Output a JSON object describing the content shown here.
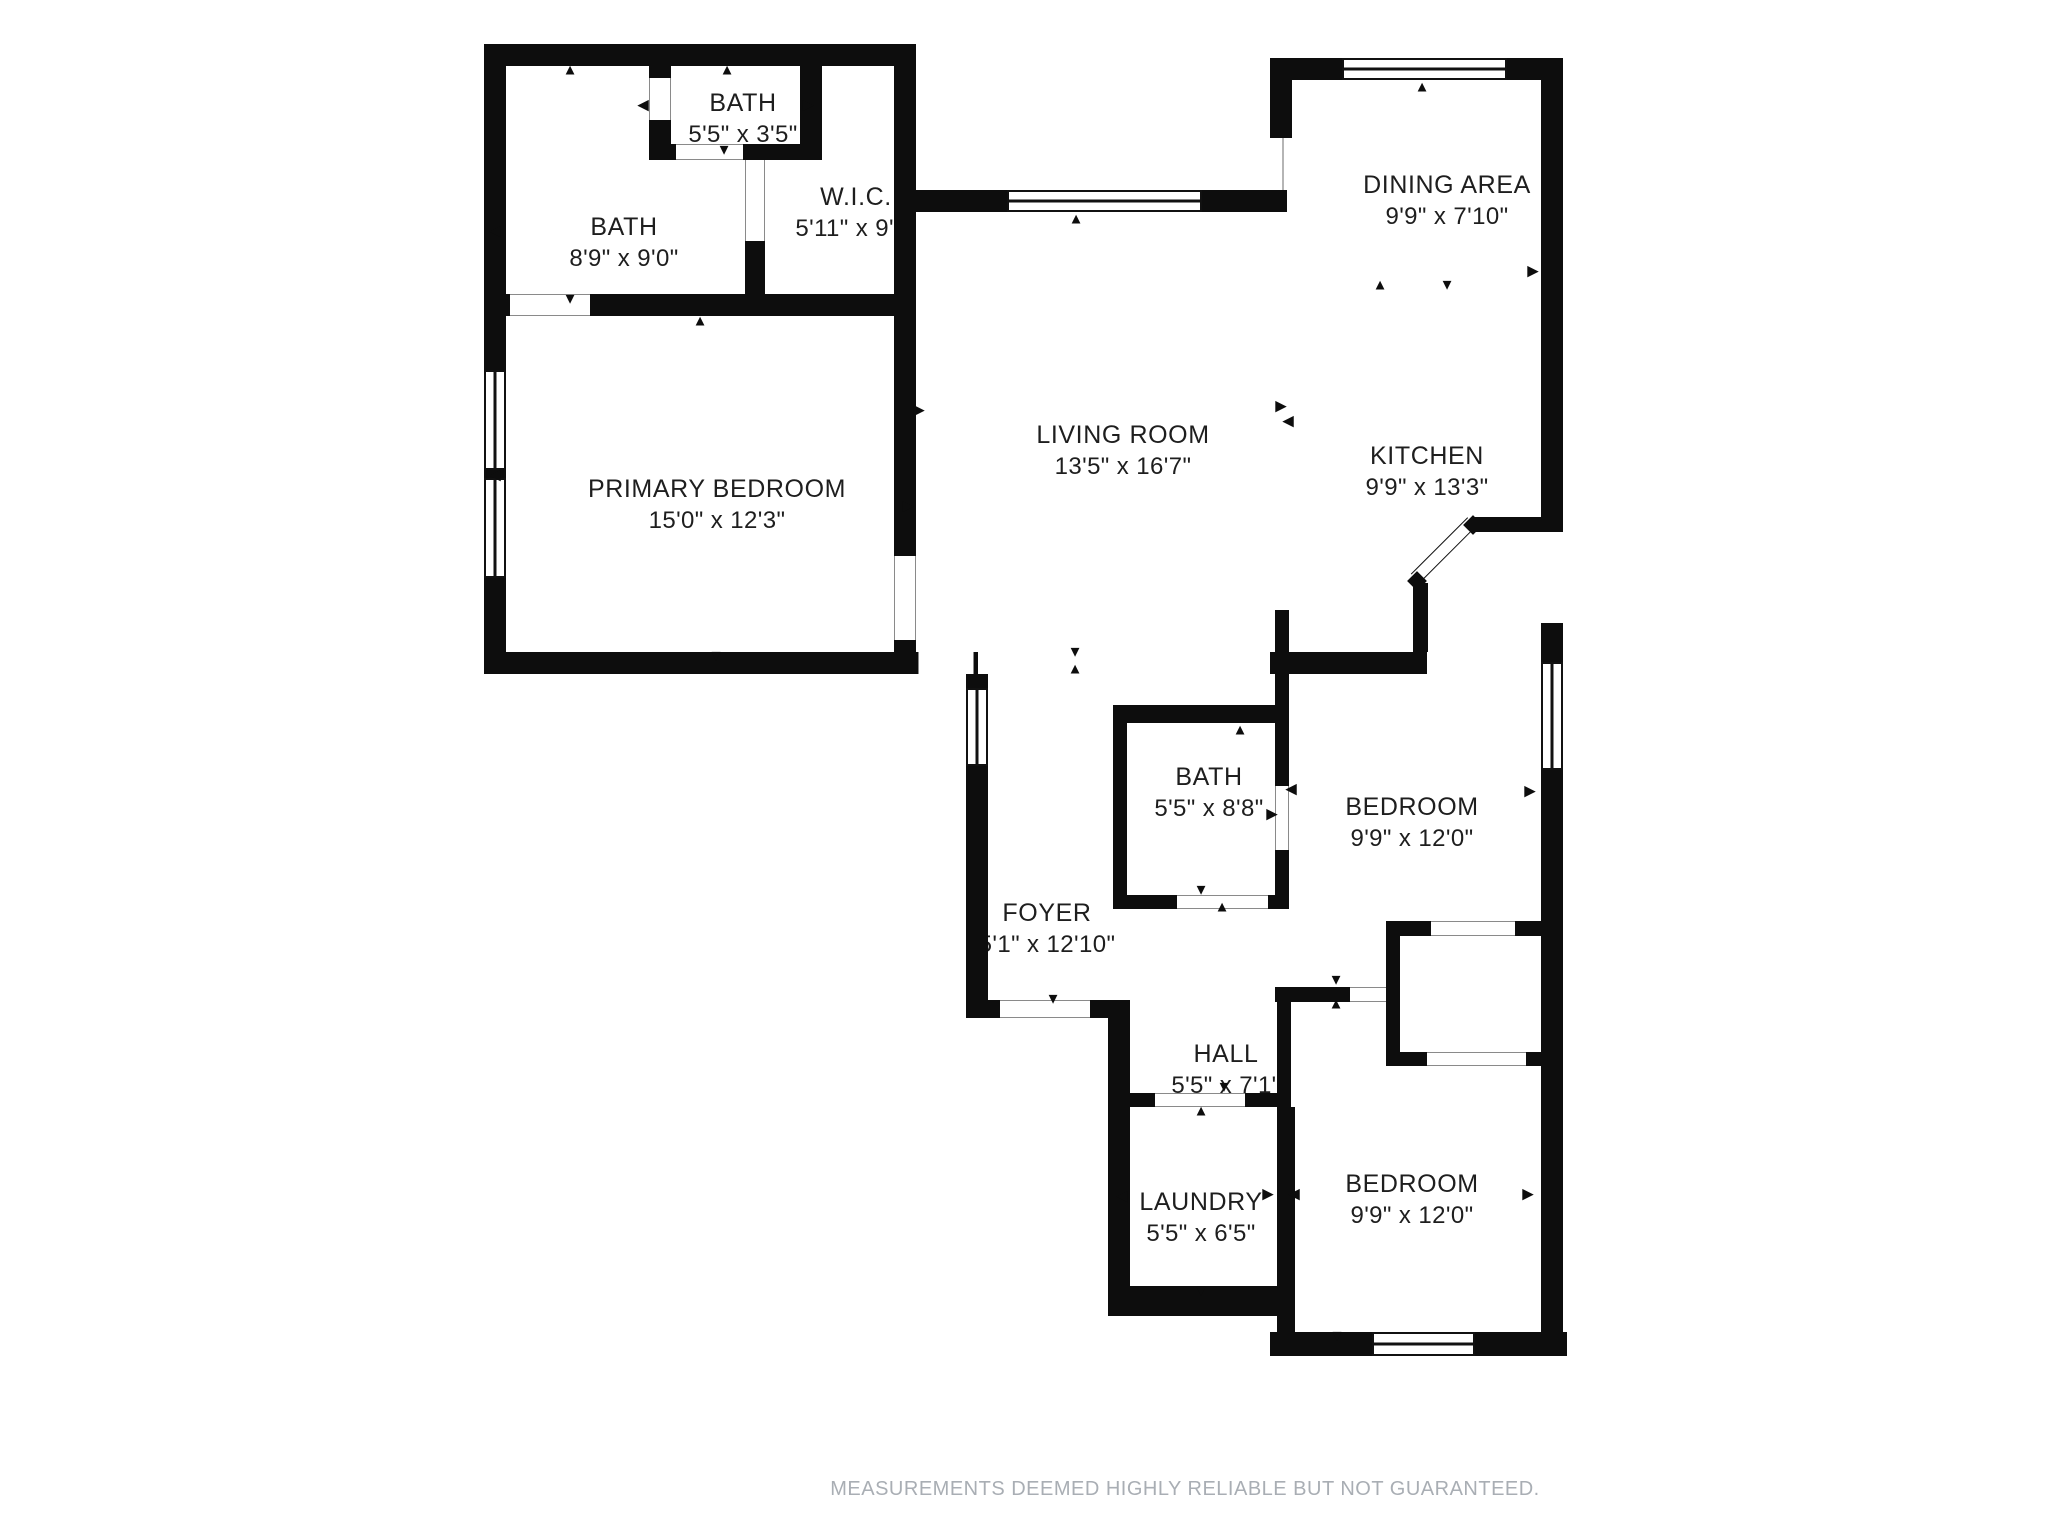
{
  "plan": {
    "wall_color": "#0d0d0d",
    "background_color": "#ffffff",
    "footer_color": "#a9aeb4"
  },
  "rooms": [
    {
      "id": "bath-small",
      "name": "BATH",
      "dims": "5'5\" x 3'5\""
    },
    {
      "id": "bath-main",
      "name": "BATH",
      "dims": "8'9\" x 9'0\""
    },
    {
      "id": "wic",
      "name": "W.I.C.",
      "dims": "5'11\" x 9'0\""
    },
    {
      "id": "dining-area",
      "name": "DINING AREA",
      "dims": "9'9\" x 7'10\""
    },
    {
      "id": "living-room",
      "name": "LIVING ROOM",
      "dims": "13'5\" x 16'7\""
    },
    {
      "id": "kitchen",
      "name": "KITCHEN",
      "dims": "9'9\" x 13'3\""
    },
    {
      "id": "primary-bedroom",
      "name": "PRIMARY BEDROOM",
      "dims": "15'0\" x 12'3\""
    },
    {
      "id": "bath-mid",
      "name": "BATH",
      "dims": "5'5\" x 8'8\""
    },
    {
      "id": "bedroom-upper",
      "name": "BEDROOM",
      "dims": "9'9\" x 12'0\""
    },
    {
      "id": "foyer",
      "name": "FOYER",
      "dims": "5'1\" x 12'10\""
    },
    {
      "id": "hall",
      "name": "HALL",
      "dims": "5'5\" x 7'1\""
    },
    {
      "id": "laundry",
      "name": "LAUNDRY",
      "dims": "5'5\" x 6'5\""
    },
    {
      "id": "bedroom-lower",
      "name": "BEDROOM",
      "dims": "9'9\" x 12'0\""
    }
  ],
  "footer": {
    "disclaimer": "MEASUREMENTS DEEMED HIGHLY RELIABLE BUT NOT GUARANTEED."
  }
}
